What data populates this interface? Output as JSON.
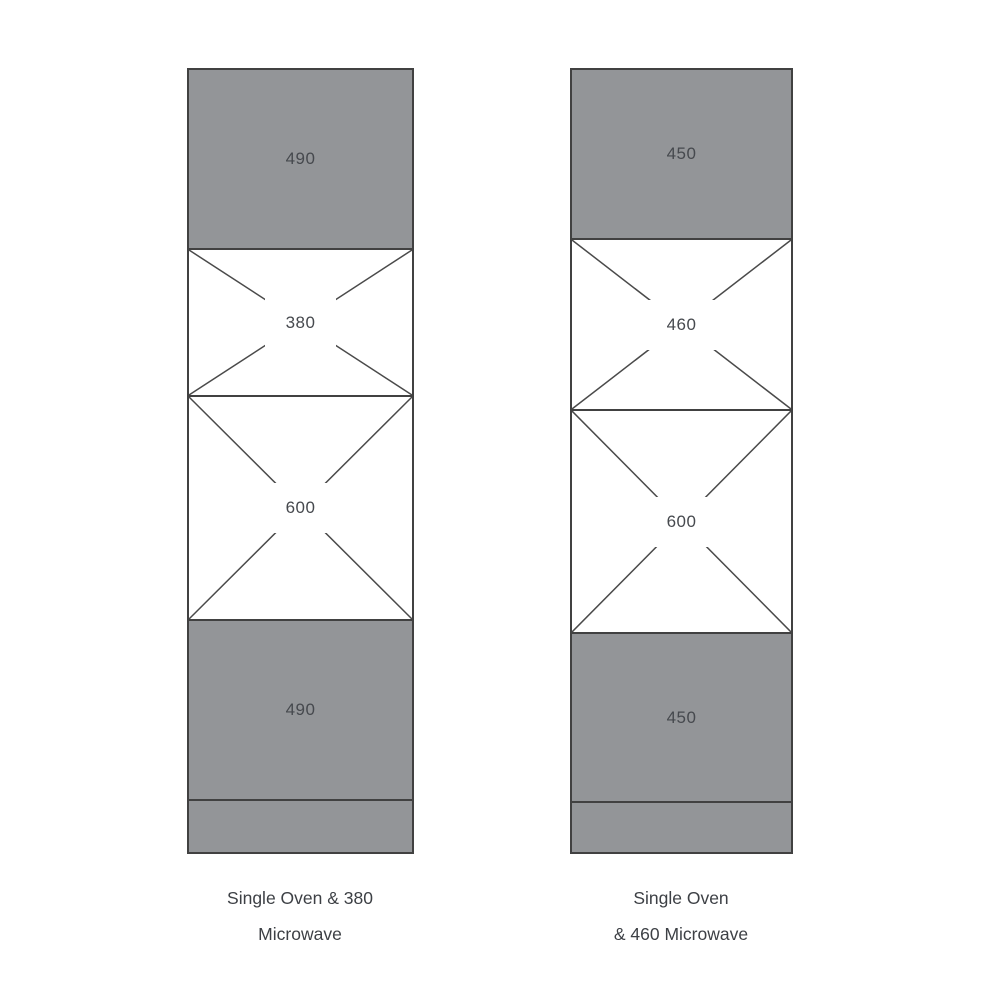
{
  "diagram": {
    "fill_color": "#939598",
    "line_color": "#414141",
    "label_color": "#46494e",
    "columns": [
      {
        "name": "single-oven-380-microwave-tower",
        "sections": [
          {
            "type": "solid",
            "label": "490"
          },
          {
            "type": "cross",
            "label": "380"
          },
          {
            "type": "cross",
            "label": "600"
          },
          {
            "type": "solid",
            "label": "490"
          },
          {
            "type": "plinth",
            "label": ""
          }
        ],
        "caption_line1": "Single Oven & 380",
        "caption_line2": "Microwave"
      },
      {
        "name": "single-oven-460-microwave-tower",
        "sections": [
          {
            "type": "solid",
            "label": "450"
          },
          {
            "type": "cross",
            "label": "460"
          },
          {
            "type": "cross",
            "label": "600"
          },
          {
            "type": "solid",
            "label": "450"
          },
          {
            "type": "plinth",
            "label": ""
          }
        ],
        "caption_line1": "Single Oven",
        "caption_line2": "& 460 Microwave"
      }
    ]
  }
}
